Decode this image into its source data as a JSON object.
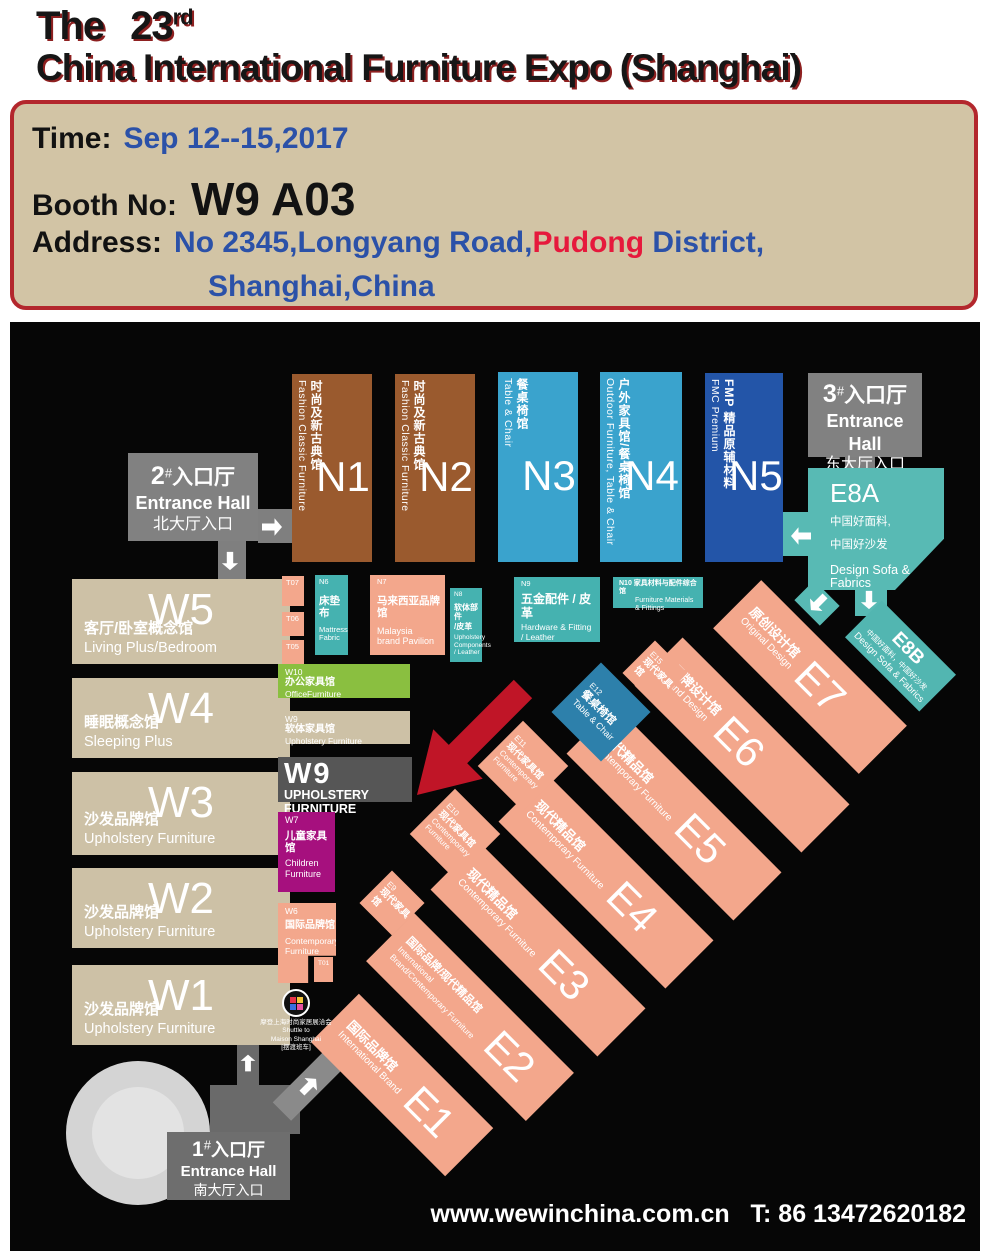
{
  "title": {
    "the": "The",
    "number": "23",
    "ordinal": "rd",
    "line2": "China International Furniture Expo (Shanghai)"
  },
  "info": {
    "time_label": "Time:",
    "time_value": "Sep 12--15,2017",
    "booth_label": "Booth No:",
    "booth_value": "W9 A03",
    "address_label": "Address:",
    "address_blue1": "No 2345,Longyang Road,",
    "address_red": "Pudong",
    "address_blue2": " District,",
    "address_line2": "Shanghai,China"
  },
  "footer": {
    "website": "www.wewinchina.com.cn",
    "phone": "T: 86 13472620182"
  },
  "colors": {
    "border_red": "#b3272d",
    "panel_bg": "#d2c4a5",
    "blue_text": "#2b51a8",
    "highlight_red": "#e6193c",
    "brown": "#9a5a2e",
    "cyan": "#3aa3cd",
    "dark_blue": "#2355a8",
    "teal": "#45b2b0",
    "teal_light": "#58bab4",
    "salmon": "#f3a78c",
    "beige": "#cdc1a6",
    "green": "#8abf40",
    "magenta": "#a6107e",
    "entrance_gray": "#818181",
    "booth_gray": "#565656",
    "arrow_red": "#c01527",
    "steel_blue": "#2d80ab"
  },
  "map": {
    "entrance2": {
      "num": "2",
      "hash": "#",
      "cn": "入口厅",
      "en": "Entrance Hall",
      "sub": "北大厅入口"
    },
    "entrance3": {
      "num": "3",
      "hash": "#",
      "cn": "入口厅",
      "en": "Entrance Hall",
      "sub": "东大厅入口"
    },
    "entrance1": {
      "num": "1",
      "hash": "#",
      "cn": "入口厅",
      "en": "Entrance Hall",
      "sub": "南大厅入口"
    },
    "n1": {
      "code": "N1",
      "cn": "时尚及新古典馆",
      "en": "Fashion Classic Furniture"
    },
    "n2": {
      "code": "N2",
      "cn": "时尚及新古典馆",
      "en": "Fashion Classic Furniture"
    },
    "n3": {
      "code": "N3",
      "cn": "餐桌椅馆",
      "en": "Table & Chair"
    },
    "n4": {
      "code": "N4",
      "cn": "户外家具馆/餐桌椅馆",
      "en": "Outdoor Furniture, Table & Chair"
    },
    "n5": {
      "code": "N5",
      "cn": "FMP 精品原辅材料",
      "en": "FMC Premium"
    },
    "w5": {
      "code": "W5",
      "cn": "客厅/卧室概念馆",
      "en": "Living Plus/Bedroom"
    },
    "w4": {
      "code": "W4",
      "cn": "睡眠概念馆",
      "en": "Sleeping Plus"
    },
    "w3": {
      "code": "W3",
      "cn": "沙发品牌馆",
      "en": "Upholstery Furniture"
    },
    "w2": {
      "code": "W2",
      "cn": "沙发品牌馆",
      "en": "Upholstery Furniture"
    },
    "w1": {
      "code": "W1",
      "cn": "沙发品牌馆",
      "en": "Upholstery Furniture"
    },
    "t07": "T07",
    "t06": "T06",
    "t05": "T05",
    "t01": "T01",
    "n6": {
      "code": "N6",
      "cn": "床垫布",
      "en1": "Mattress",
      "en2": "Fabric"
    },
    "n7": {
      "code": "N7",
      "cn": "马来西亚品牌馆",
      "en1": "Malaysia",
      "en2": "brand Pavilion"
    },
    "n8": {
      "code": "N8",
      "cn1": "软体部件",
      "cn2": "/皮革",
      "en1": "Upholstery",
      "en2": "Components",
      "en3": "/ Leather"
    },
    "n9": {
      "code": "N9",
      "cn": "五金配件 / 皮革",
      "en1": "Hardware & Fitting",
      "en2": "/ Leather"
    },
    "n10": {
      "line1": "N10 家具材料与配件综合馆",
      "en1": "Furniture Materials",
      "en2": "& Fittings"
    },
    "w10": {
      "code": "W10",
      "cn": "办公家具馆",
      "en": "OfficeFurniture"
    },
    "w9_small": {
      "code": "W9",
      "cn": "软体家具馆",
      "en": "Upholstery Furniture"
    },
    "w9_big": {
      "code": "W9",
      "en": "UPHOLSTERY FURNITURE"
    },
    "w7": {
      "code": "W7",
      "cn": "儿童家具馆",
      "en1": "Children",
      "en2": "Furniture"
    },
    "w6": {
      "code": "W6",
      "cn": "国际品牌馆",
      "en1": "Contemporary",
      "en2": "Furniture"
    },
    "e1": {
      "code": "E1",
      "cn": "国际品牌馆",
      "en": "International Brand"
    },
    "e2": {
      "code": "E2",
      "cn": "国际品牌/现代精品馆",
      "en": "International Brand/Contemporary Furniture"
    },
    "e3": {
      "code": "E3",
      "cn": "现代精品馆",
      "en": "Contemporary Furniture"
    },
    "e4": {
      "code": "E4",
      "cn": "现代精品馆",
      "en": "Contemporary Furniture"
    },
    "e5": {
      "code": "E5",
      "cn": "现代精品馆",
      "en": "Contemporary Furniture"
    },
    "e6": {
      "code": "E6",
      "cn": "品牌设计馆",
      "en": "Brand Design"
    },
    "e7": {
      "code": "E7",
      "cn": "原创设计馆",
      "en": "Original Design"
    },
    "e9": {
      "code": "E9",
      "cn": "现代家具馆"
    },
    "e10": {
      "code": "E10",
      "cn": "现代家具馆",
      "en1": "Contemporary",
      "en2": "Furniture"
    },
    "e11": {
      "code": "E11",
      "cn": "现代家具馆",
      "en1": "Contemporary",
      "en2": "Furniture"
    },
    "e12": {
      "code": "E12",
      "cn": "餐桌椅馆",
      "en": "Table & Chair"
    },
    "e15": {
      "code": "E15",
      "cn": "现代家具馆"
    },
    "e8a": {
      "code": "E8A",
      "cn1": "中国好面料,",
      "cn2": "中国好沙发",
      "en": "Design Sofa & Fabrics"
    },
    "e8b": {
      "code": "E8B",
      "cn": "中国好面料，中国好沙发",
      "en": "Design Sofa & Fabrics"
    },
    "shuttle": {
      "cn1": "摩登上海时尚家居展洽会",
      "en1": "Shuttle to",
      "en2": "Maison Shanghai",
      "cn2": "[摆渡班车]"
    }
  }
}
